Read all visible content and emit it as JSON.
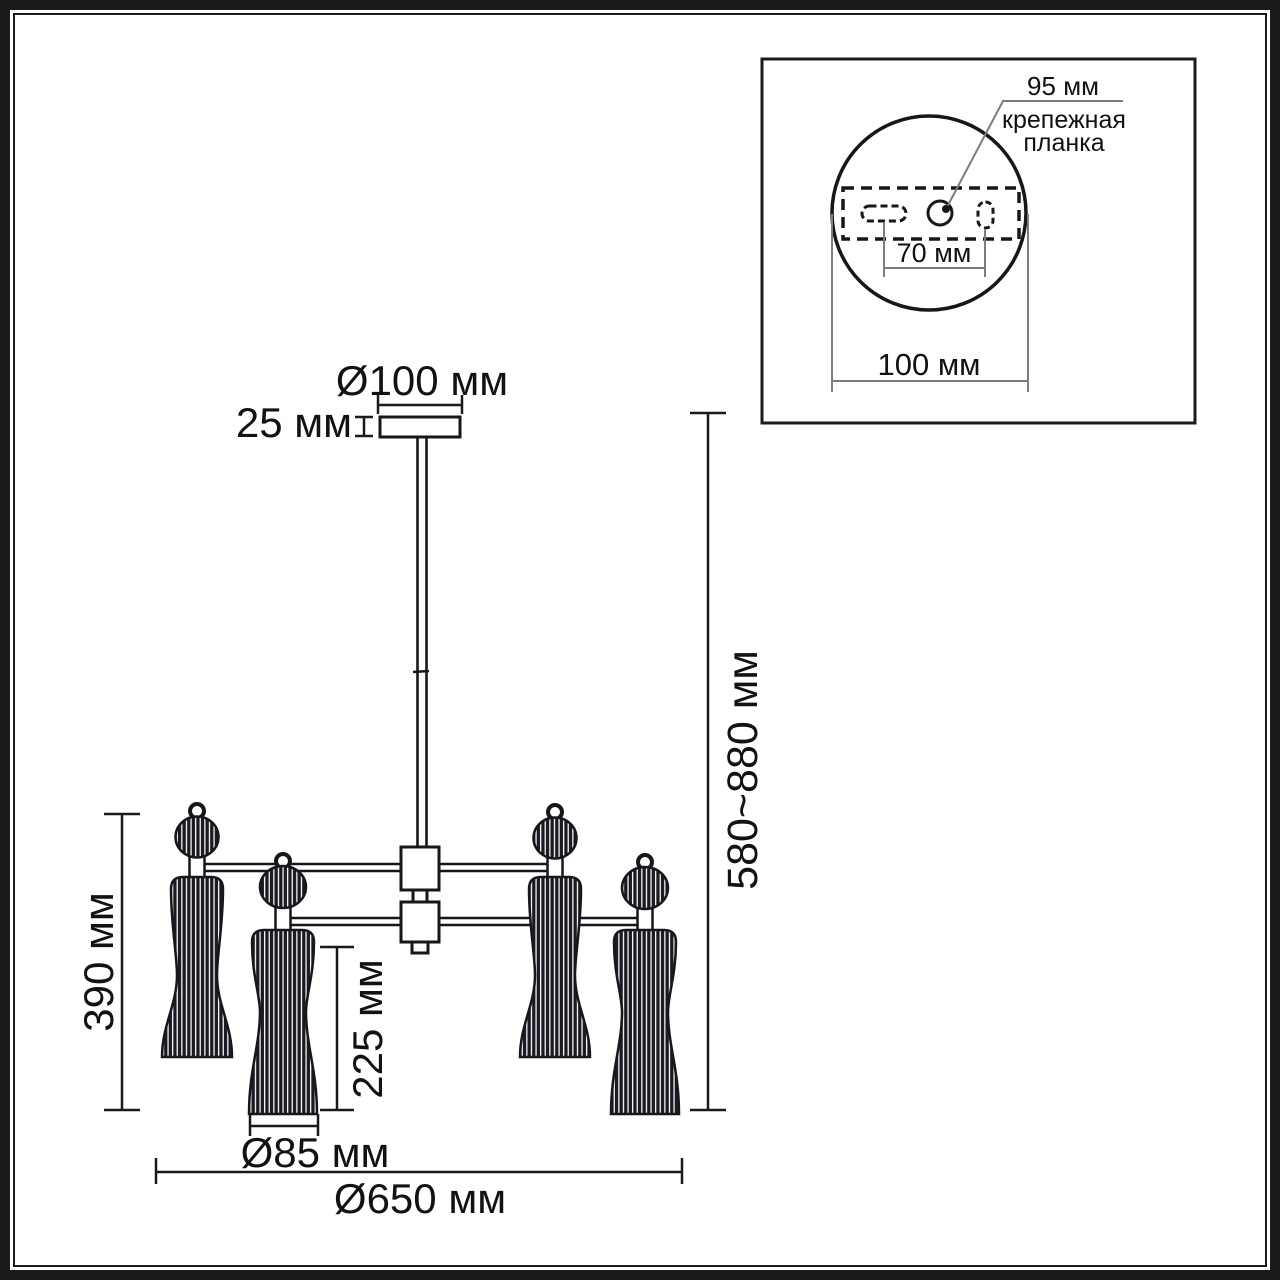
{
  "main_view": {
    "canopy_diameter": "Ø100 мм",
    "canopy_height": "25 мм",
    "height_range": "580~880 мм",
    "shade_total_height": "390 мм",
    "shade_glass_height": "225 мм",
    "shade_diameter": "Ø85 мм",
    "fixture_diameter": "Ø650 мм"
  },
  "inset_view": {
    "plate_width": "95 мм",
    "bracket_label_line1": "крепежная",
    "bracket_label_line2": "планка",
    "slot_spacing": "70 мм",
    "base_diameter": "100 мм"
  }
}
